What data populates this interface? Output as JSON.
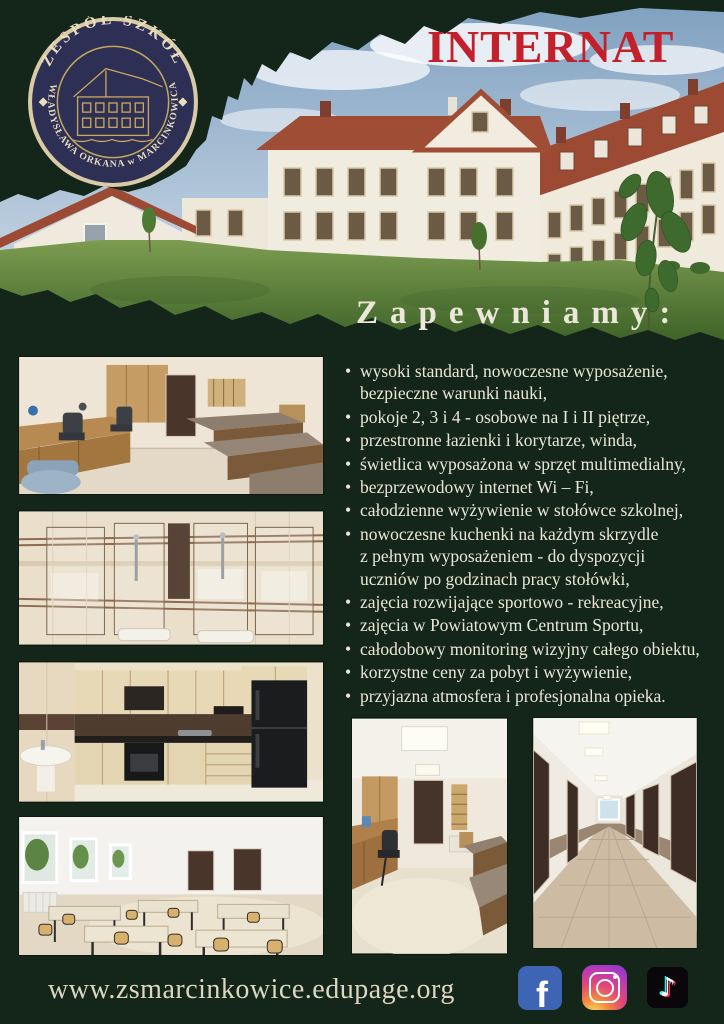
{
  "title": "INTERNAT",
  "logo": {
    "top_text": "ZESPÓŁ SZKÓŁ",
    "bottom_text": "im. WŁADYSŁAWA ORKANA w MARCINKOWICACH"
  },
  "heading": "Zapewniamy:",
  "features": {
    "items": [
      "wysoki standard, nowoczesne wyposażenie,\nbezpieczne warunki nauki,",
      "pokoje 2, 3 i 4 - osobowe na I i II piętrze,",
      "przestronne łazienki i korytarze, winda,",
      "świetlica wyposażona w sprzęt multimedialny,",
      "bezprzewodowy internet Wi – Fi,",
      "całodzienne wyżywienie w stołówce szkolnej,",
      "nowoczesne kuchenki na każdym skrzydle\nz pełnym wyposażeniem - do dyspozycji\nuczniów po godzinach pracy stołówki,",
      "zajęcia rozwijające sportowo - rekreacyjne,",
      "zajęcia w Powiatowym Centrum Sportu,",
      "całodobowy monitoring wizyjny całego obiektu,",
      "korzystne ceny za pobyt i wyżywienie,",
      "przyjazna atmosfera i profesjonalna opieka."
    ]
  },
  "footer": {
    "website": "www.zsmarcinkowice.edupage.org",
    "social": [
      {
        "name": "facebook",
        "glyph": "f"
      },
      {
        "name": "instagram",
        "glyph": ""
      },
      {
        "name": "tiktok",
        "glyph": "♪"
      }
    ]
  },
  "photos": {
    "hero": "school building exterior with lawn",
    "left_column": [
      "dorm bedroom with desks and beds",
      "bathroom with glass showers",
      "kitchen with black fridge",
      "dining room with tables and chairs"
    ],
    "bottom_row": [
      "dorm room with wardrobe and beds",
      "long corridor with doors"
    ]
  },
  "colors": {
    "background": "#142619",
    "title_red": "#c2202b",
    "text_cream": "#eae6d8",
    "logo_navy": "#2d2f55",
    "logo_gold": "#d9cba6",
    "facebook_blue": "#3e64b4",
    "tiktok_cyan": "#25f4ee",
    "tiktok_pink": "#fe2c55"
  }
}
